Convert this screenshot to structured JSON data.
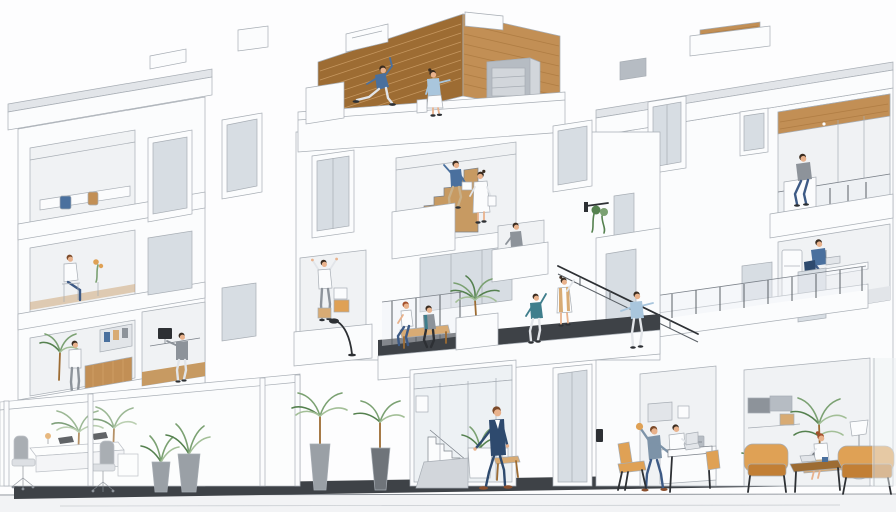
{
  "scene": {
    "title": "Building cross-section illustration",
    "description": "Isometric cutaway illustration of a modern white multi-storey building with a wooden roof deck, open staircases, balconies with glass railings, apartments, offices, an entrance lobby and a cafe lounge, populated with people, potted plants and warm orange furniture.",
    "style": "minimal white architectural render with warm wood and orange accents",
    "ground": "light sidewalk with dark plinth strip"
  },
  "colors": {
    "background": "#fdfdfe",
    "white": "#fbfcfd",
    "shade1": "#f0f2f4",
    "shade2": "#e2e5e9",
    "shade3": "#d2d6db",
    "line": "#a7adb4",
    "line_dark": "#7c828a",
    "glass": "#edf1f4",
    "glass_dark": "#d7dde3",
    "dark_floor": "#3e4247",
    "wood": "#c28f55",
    "wood_dark": "#9d6c33",
    "wood_light": "#d8ab74",
    "wood_floor": "#c79a62",
    "plant": "#7ba172",
    "plant_dark": "#55814f",
    "plant_light": "#a3bf97",
    "pot_grey": "#9aa0a6",
    "pot_dark": "#6f747a",
    "orange": "#dfa155",
    "orange_dark": "#c27f35",
    "navy": "#2e4a6e",
    "denim": "#3d5a85",
    "blue_shirt": "#4a709e",
    "light_blue": "#a9c6dd",
    "teal": "#3f7e8c",
    "steel": "#7d93a8",
    "khaki": "#c9b089",
    "skin": "#e9b28c",
    "hair_brown": "#7b4a2a",
    "hair_dark": "#3a2c20",
    "hair_red": "#a3502c",
    "shoe": "#8a4f2e",
    "grey_furniture": "#8d939a",
    "metal": "#b6bcc3",
    "black": "#2d3034",
    "sidewalk": "#f2f3f5"
  },
  "figures": [
    {
      "name": "roof-dancer",
      "desc": "Man in a blue top exercising on the wooden roof deck"
    },
    {
      "name": "roof-pointer",
      "desc": "Woman in a light blue cardigan standing at the roof deck parapet"
    },
    {
      "name": "stair-climber",
      "desc": "Woman in a blue top carrying laundry up the open wooden staircase"
    },
    {
      "name": "stair-stander",
      "desc": "Woman in a white dress standing on the staircase landing"
    },
    {
      "name": "loggia-sitter",
      "desc": "Man sitting on the top loggia parapet under a wooden ceiling"
    },
    {
      "name": "upper-desk-worker",
      "desc": "Man in a blue shirt working at a desk on the upper floor"
    },
    {
      "name": "bench-couple",
      "desc": "Couple sitting on a wooden bench on the shared terrace"
    },
    {
      "name": "railing-worker",
      "desc": "Person in teal reaching up at the terrace railing"
    },
    {
      "name": "terrace-vest-woman",
      "desc": "Woman in a white dress and tan vest reaching for the stair handrail"
    },
    {
      "name": "terrace-stretcher",
      "desc": "Woman in a light blue top stretching on the right terrace"
    },
    {
      "name": "small-balcony-man",
      "desc": "Man standing on a small mid-level balcony"
    },
    {
      "name": "box-stretcher",
      "desc": "Person stretching beside moving boxes on a left balcony"
    },
    {
      "name": "tower-sitting-woman",
      "desc": "Woman seated on a chair in the left tower apartment"
    },
    {
      "name": "tower-office-woman",
      "desc": "Woman at a wood-slat counter in the left tower office"
    },
    {
      "name": "bay-monitor-man",
      "desc": "Man standing at a monitor desk in the middle bay"
    },
    {
      "name": "suit-walker",
      "desc": "Man in a navy suit walking past the entrance planter"
    },
    {
      "name": "cafe-snacker",
      "desc": "Man holding a snack beside a cafe table with a laptop"
    },
    {
      "name": "cafe-barista",
      "desc": "Barista in a white shirt behind the cafe counter"
    },
    {
      "name": "lounge-reader",
      "desc": "Red-haired woman sitting in the lounge with a laptop"
    }
  ],
  "objects": {
    "roof": [
      "wooden plank deck wall",
      "rooftop AC unit",
      "glass railing frames",
      "roof boxes"
    ],
    "greenery": [
      "indoor office palms",
      "paired potted yuccas",
      "two tall street palms",
      "entrance succulent planter",
      "terrace palm in white planter",
      "hanging wall plant",
      "lounge ficus",
      "lounge fern"
    ],
    "furniture": [
      "white office desk with two laptops",
      "two grey office chairs",
      "interior staircase",
      "concrete entrance bench",
      "cafe counter with espresso machine",
      "tan cafe chairs and laptop table",
      "orange armchair",
      "orange loveseat",
      "wooden coffee table",
      "floor lamp",
      "kitchen cabinets",
      "upper-floor desk with fridge",
      "terrace bench",
      "apartment bed and wardrobe"
    ]
  }
}
